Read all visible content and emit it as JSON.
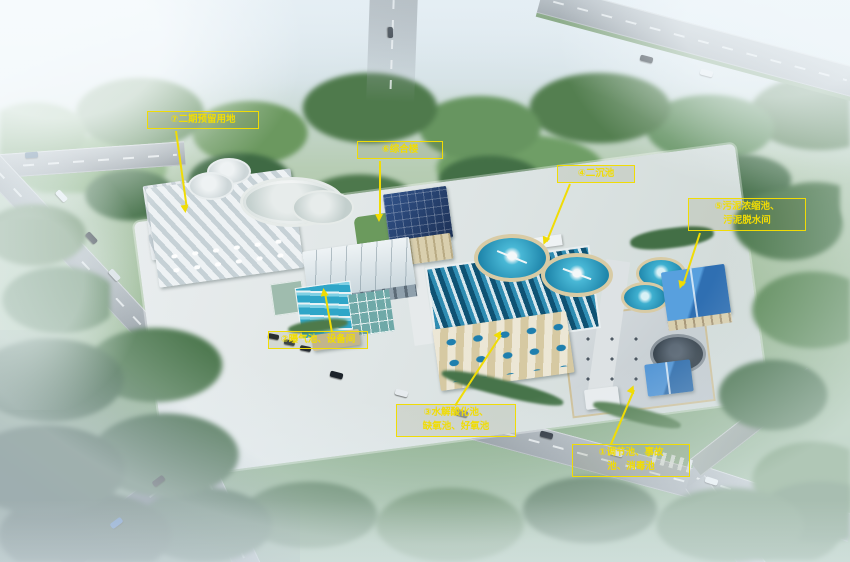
{
  "callouts": [
    {
      "id": 1,
      "line1": "①调节池、事故",
      "line2": "池、消毒池"
    },
    {
      "id": 2,
      "line1": "②曝气池、设备间",
      "line2": ""
    },
    {
      "id": 3,
      "line1": "③水解酸化池、",
      "line2": "缺氧池、好氧池"
    },
    {
      "id": 4,
      "line1": "④二沉池",
      "line2": ""
    },
    {
      "id": 5,
      "line1": "⑤污泥浓缩池、",
      "line2": "污泥脱水间"
    },
    {
      "id": 6,
      "line1": "⑥综合楼",
      "line2": ""
    },
    {
      "id": 7,
      "line1": "⑦二期预留用地",
      "line2": ""
    }
  ],
  "colors": {
    "annotation_yellow": "#f0dc05",
    "water_cyan": "#38aecd",
    "pv_roof_navy": "#27406e",
    "gable_roof_blue": "#3f86cc",
    "tree_green": "#55804f",
    "road_gray": "#98a1a8"
  }
}
